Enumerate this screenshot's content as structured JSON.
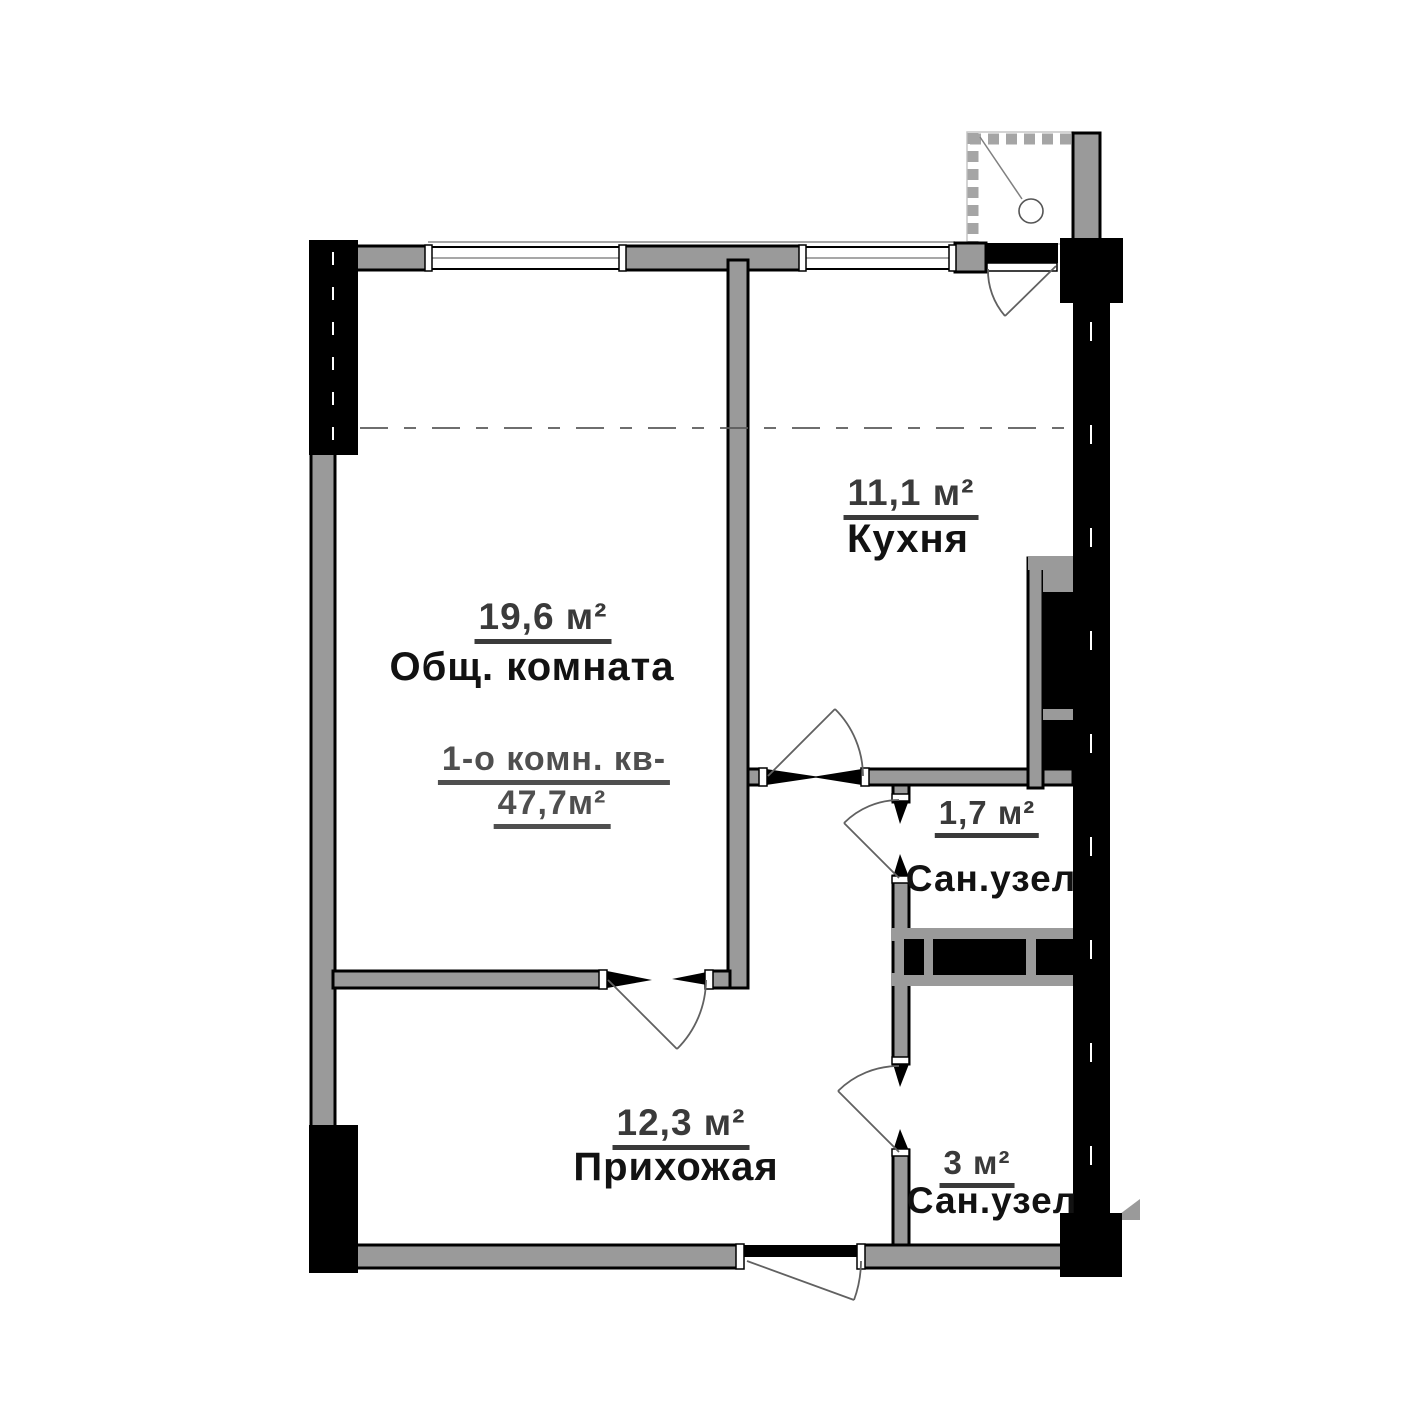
{
  "plan": {
    "apartment_title": {
      "line1": "1-о комн. кв-",
      "line2": "47,7м²"
    },
    "rooms": [
      {
        "key": "living",
        "area": "19,6 м²",
        "name": "Общ. комната"
      },
      {
        "key": "kitchen",
        "area": "11,1 м²",
        "name": "Кухня"
      },
      {
        "key": "bath_small",
        "area": "1,7 м²",
        "name": "Сан.узел"
      },
      {
        "key": "hallway",
        "area": "12,3 м²",
        "name": "Прихожая"
      },
      {
        "key": "bath_big",
        "area": "3 м²",
        "name": "Сан.узел"
      }
    ],
    "colors": {
      "wall_gray": "#9a9a9a",
      "wall_black": "#000000",
      "area_text": "#3a3a3a",
      "name_text": "#121212",
      "title_text": "#4f4f4f",
      "background": "#ffffff"
    }
  }
}
